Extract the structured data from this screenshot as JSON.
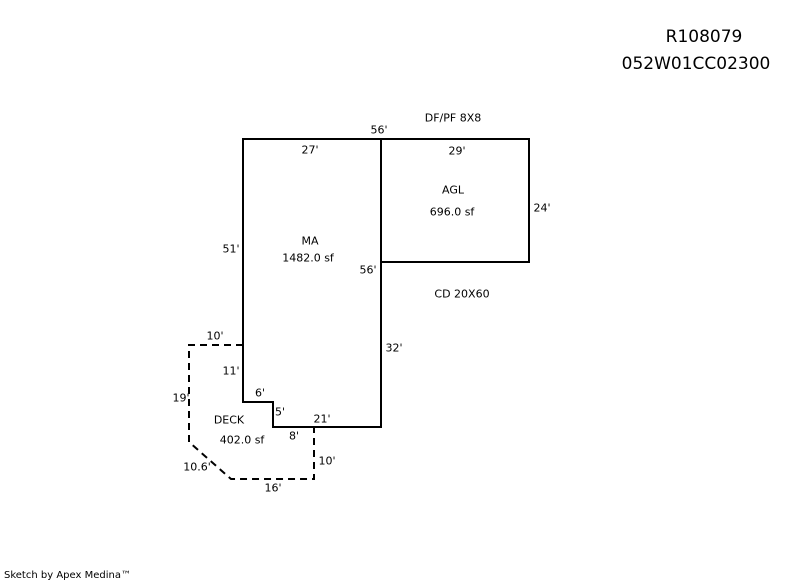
{
  "colors": {
    "background": "#ffffff",
    "line": "#000000",
    "text": "#000000"
  },
  "header": {
    "record_id": "R108079",
    "parcel_id": "052W01CC02300"
  },
  "sketch": {
    "areas": {
      "ma": {
        "code": "MA",
        "area": "1482.0 sf"
      },
      "agl": {
        "code": "AGL",
        "area": "696.0 sf"
      },
      "deck": {
        "code": "DECK",
        "area": "402.0 sf"
      }
    },
    "annotations": {
      "df_pf": "DF/PF 8X8",
      "cd": "CD 20X60"
    },
    "dims": {
      "top_56": "56'",
      "ma_top_27": "27'",
      "agl_top_29": "29'",
      "agl_right_24": "24'",
      "ma_left_51": "51'",
      "mid_56": "56'",
      "deck_top_10": "10'",
      "ma_right_32": "32'",
      "deck_11": "11'",
      "notch_6": "6'",
      "deck_left_19": "19'",
      "notch_5": "5'",
      "ma_bottom_21": "21'",
      "deck_8": "8'",
      "deck_diag_10_6": "10.6'",
      "deck_right_10": "10'",
      "deck_bottom_16": "16'"
    }
  },
  "footer": {
    "credit": "Sketch by Apex Medina™"
  }
}
